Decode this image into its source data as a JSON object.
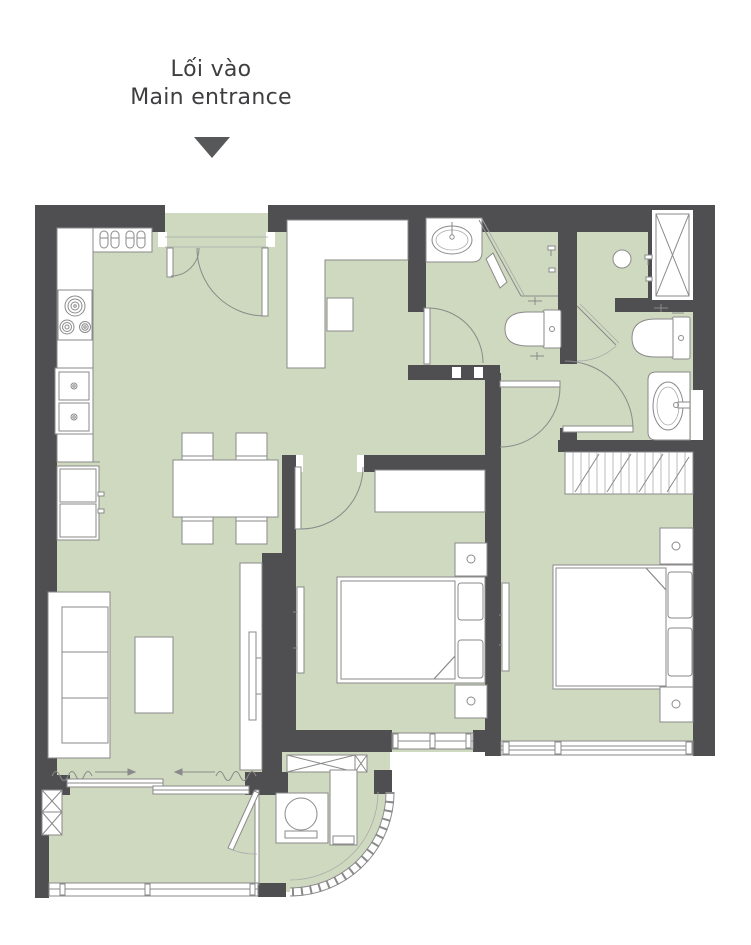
{
  "labels": {
    "entrance_line1": "Lối vào",
    "entrance_line2": "Main entrance"
  },
  "theme": {
    "wall": "#4f4f51",
    "floor": "#ced9bf",
    "line": "#8a8a8a",
    "line2": "#aaaaaa",
    "furniture": "#ffffff",
    "text": "#3e3e40",
    "arrow": "#57585a",
    "background": "#ffffff"
  },
  "fixtures": [
    "main-entrance-arrow",
    "entrance-door",
    "shoe-rack",
    "shoes",
    "hall-cabinet",
    "stool",
    "cooktop",
    "kitchen-counter",
    "kitchen-sink",
    "refrigerator",
    "dining-table",
    "dining-chairs",
    "sofa",
    "coffee-table",
    "tv-cabinet",
    "living-tv",
    "bathroom1-sink",
    "bathroom1-shower",
    "bathroom1-toilet",
    "bathroom1-door",
    "bathroom2-shower-drain",
    "duct-shaft",
    "bathroom2-toilet",
    "bathroom2-sink",
    "bathroom2-door",
    "ensuite-door",
    "bedroom1-door",
    "bedroom1-desk",
    "bedroom1-bed",
    "bedroom1-nightstands",
    "bedroom1-tv",
    "bedroom1-window",
    "bedroom2-door",
    "wardrobe",
    "bedroom2-bed",
    "bedroom2-nightstands",
    "bedroom2-tv",
    "bedroom2-window",
    "balcony-sliding-door",
    "curtains",
    "balcony-partition-door",
    "washing-machine",
    "balcony-shelf",
    "ac-platform",
    "column",
    "balcony-railing",
    "curved-railing"
  ]
}
